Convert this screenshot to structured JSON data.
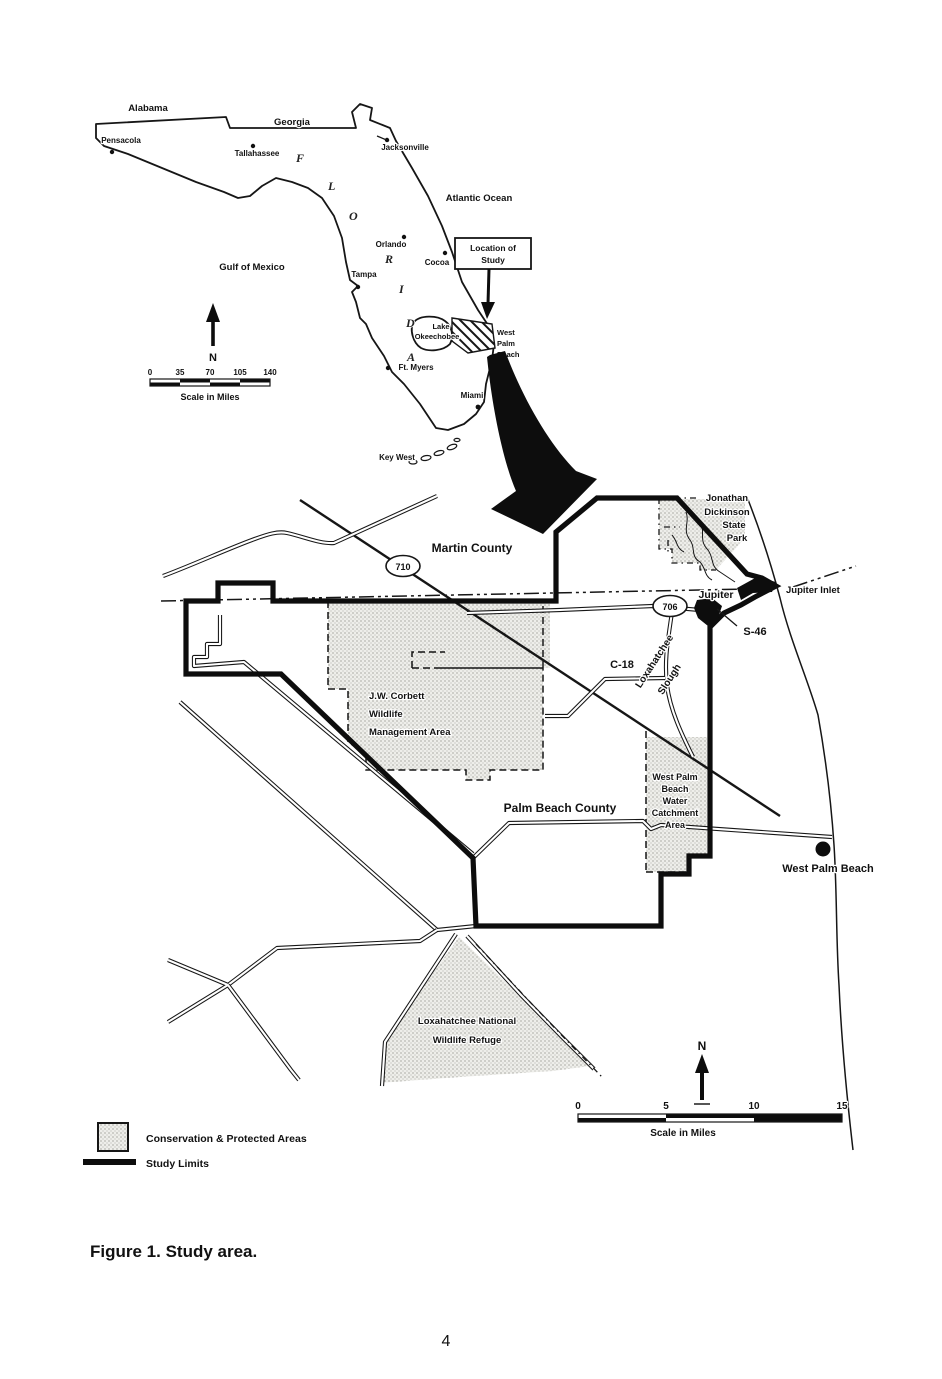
{
  "overview": {
    "alabama": "Alabama",
    "georgia": "Georgia",
    "florida_letters": [
      "F",
      "L",
      "O",
      "R",
      "I",
      "D",
      "A"
    ],
    "cities": {
      "pensacola": "Pensacola",
      "tallahassee": "Tallahassee",
      "jacksonville": "Jacksonville",
      "orlando": "Orlando",
      "cocoa": "Cocoa",
      "tampa": "Tampa",
      "ft_myers": "Ft. Myers",
      "miami": "Miami",
      "key_west": "Key West"
    },
    "water": {
      "atlantic": "Atlantic Ocean",
      "gulf": "Gulf of Mexico",
      "lake_line1": "Lake",
      "lake_line2": "Okeechobee"
    },
    "west_palm_beach": [
      "West",
      "Palm",
      "Beach"
    ],
    "callout": [
      "Location of",
      "Study"
    ],
    "north_label": "N",
    "scale": {
      "ticks": [
        "0",
        "35",
        "70",
        "105",
        "140"
      ],
      "label": "Scale in Miles"
    }
  },
  "detail": {
    "martin_county": "Martin County",
    "palm_beach_county": "Palm Beach County",
    "route_710": "710",
    "route_706": "706",
    "park": [
      "Jonathan",
      "Dickinson",
      "State",
      "Park"
    ],
    "jupiter": "Jupiter",
    "jupiter_inlet": "Jupiter Inlet",
    "s46": "S-46",
    "c18": "C-18",
    "slough": [
      "Loxahatchee",
      "Slough"
    ],
    "corbett": [
      "J.W. Corbett",
      "Wildlife",
      "Management Area"
    ],
    "catchment": [
      "West Palm",
      "Beach",
      "Water",
      "Catchment",
      "Area"
    ],
    "west_palm_beach_city": "West Palm Beach",
    "refuge": [
      "Loxahatchee National",
      "Wildlife Refuge"
    ],
    "north_label": "N",
    "scale": {
      "ticks": [
        "0",
        "5",
        "10",
        "15"
      ],
      "label": "Scale in Miles"
    }
  },
  "legend": {
    "conservation": "Conservation & Protected Areas",
    "study_limits": "Study Limits"
  },
  "figure": {
    "caption": "Figure 1.  Study area.",
    "page_number": "4"
  },
  "colors": {
    "ink": "#111111",
    "paper": "#ffffff"
  }
}
